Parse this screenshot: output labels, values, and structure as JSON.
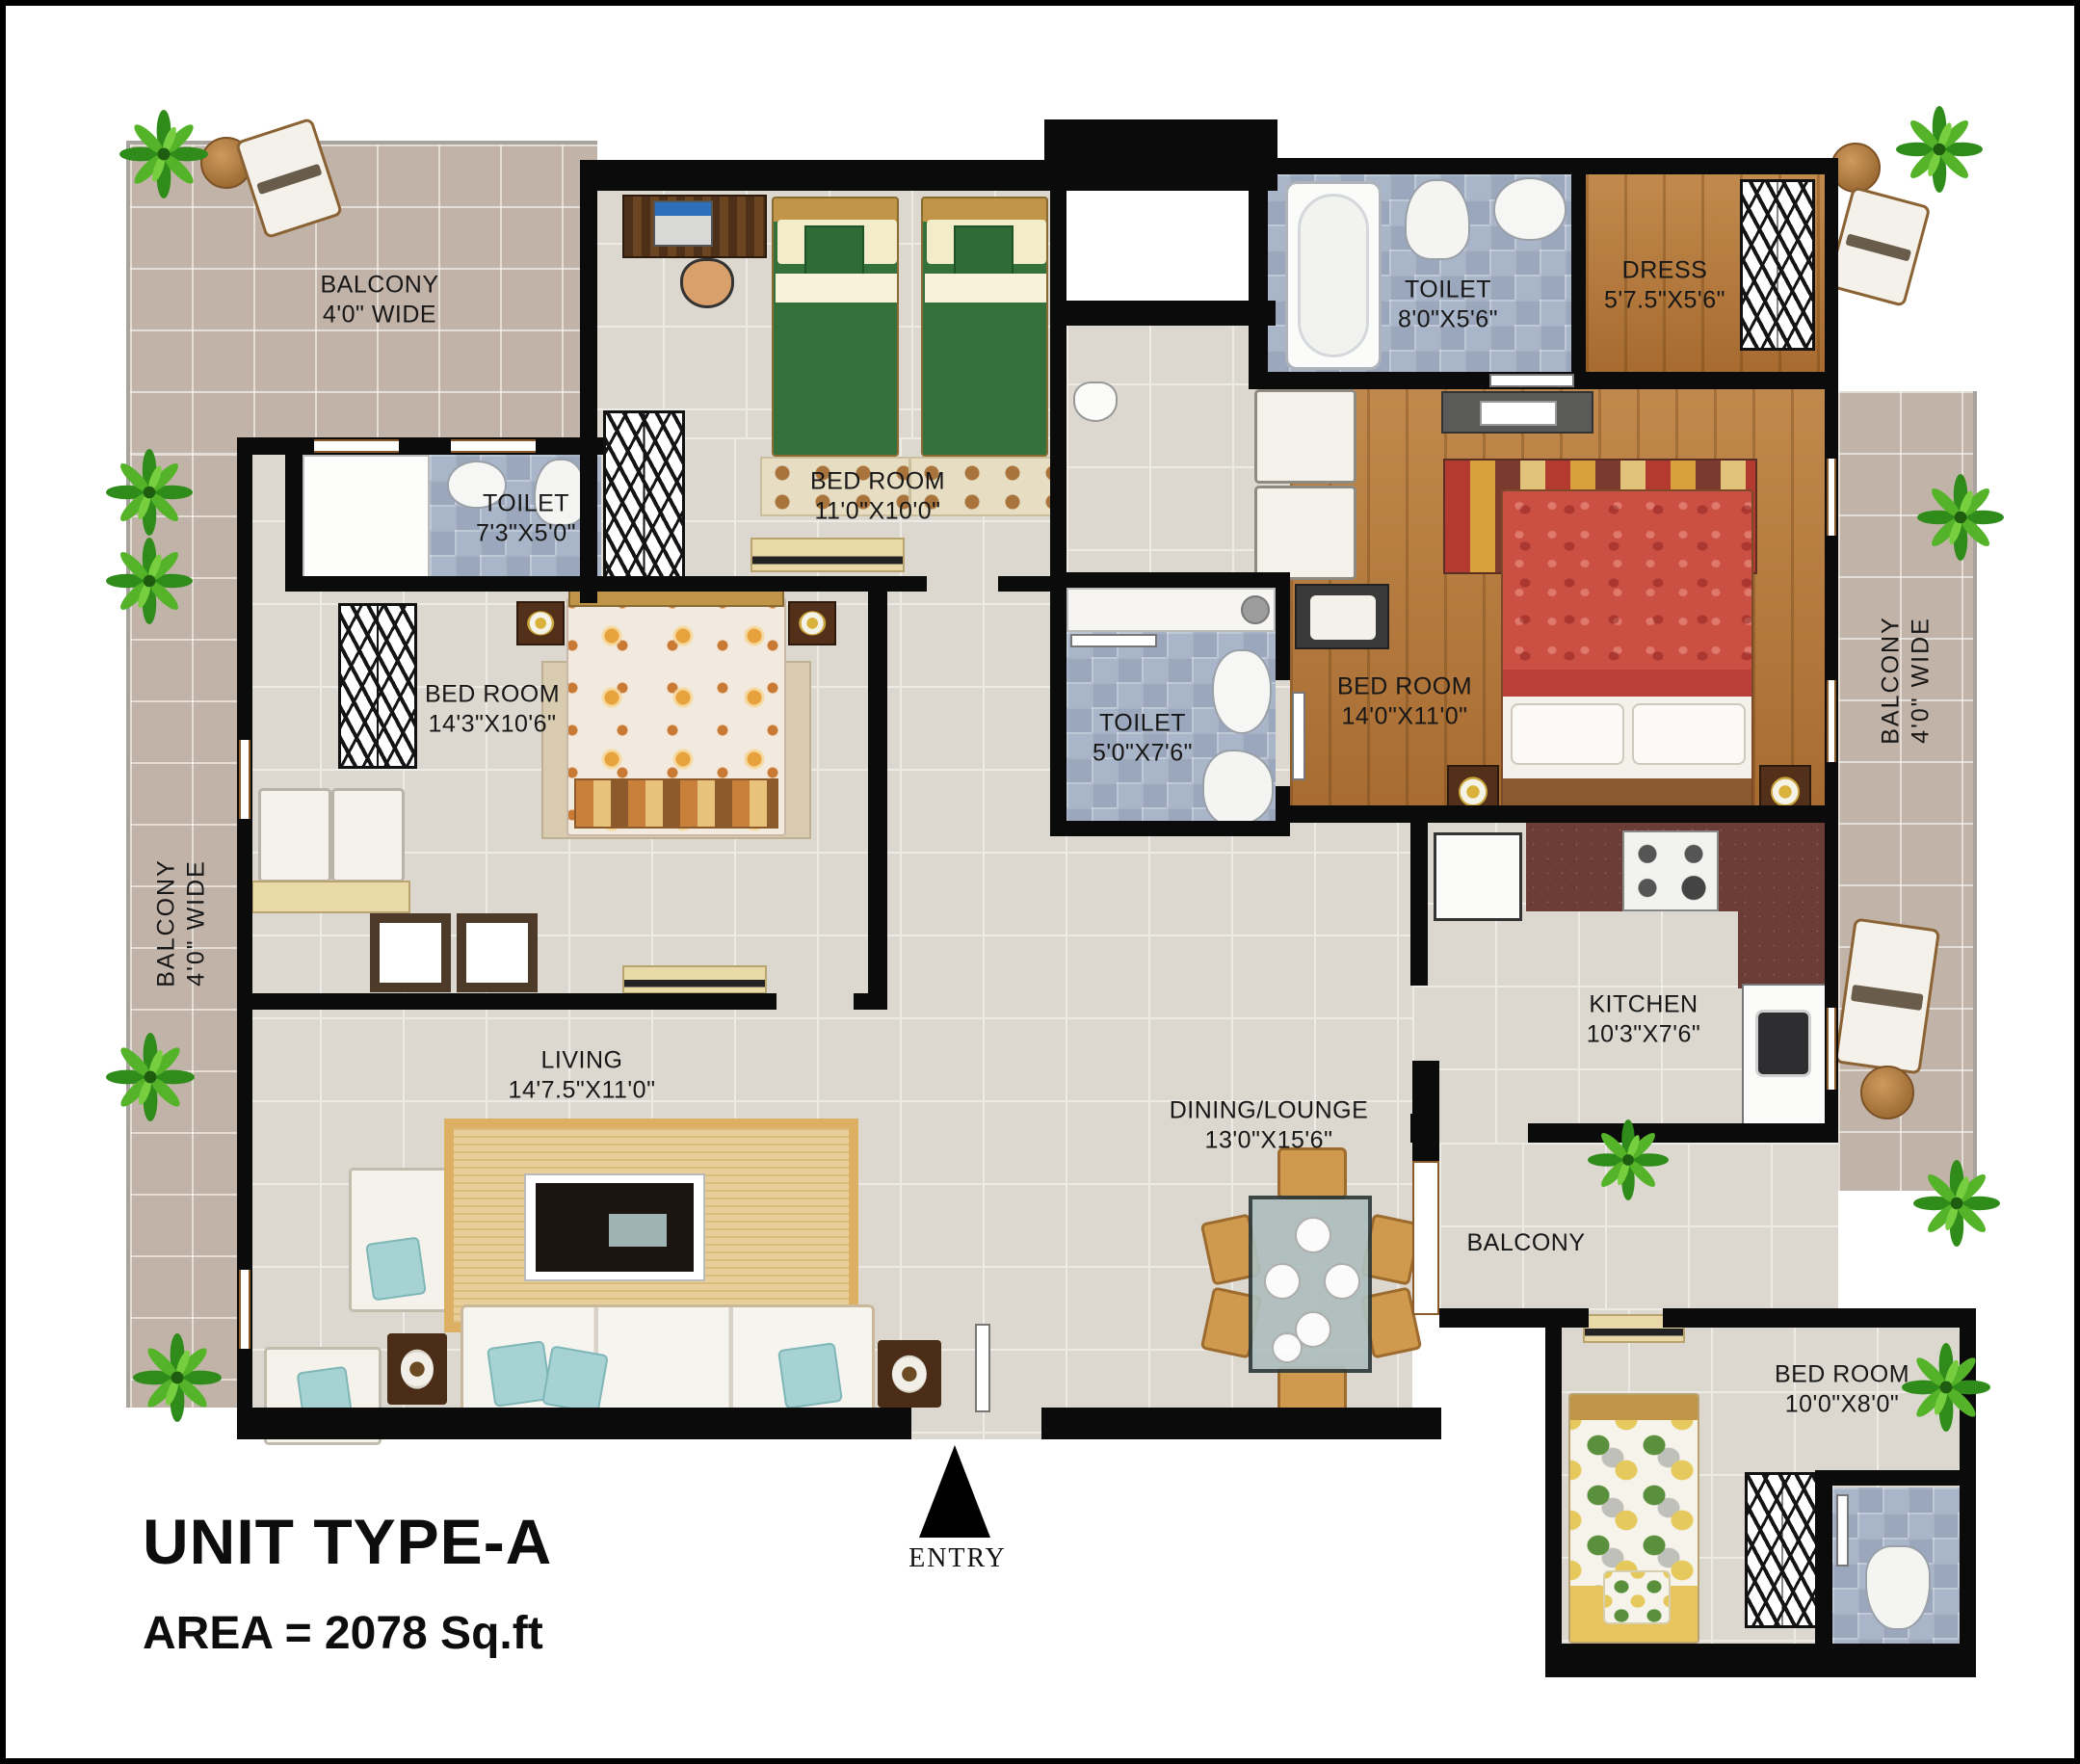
{
  "plan": {
    "unit_title": "UNIT TYPE-A",
    "area_line": "AREA = 2078 Sq.ft",
    "entry_label": "ENTRY"
  },
  "rooms": {
    "balcony_tl": {
      "name": "BALCONY",
      "size": "4'0\" WIDE"
    },
    "balcony_left": {
      "name": "BALCONY",
      "size": "4'0\" WIDE"
    },
    "balcony_right": {
      "name": "BALCONY",
      "size": "4'0\" WIDE"
    },
    "balcony_bottom": {
      "name": "BALCONY"
    },
    "toilet_tl": {
      "name": "TOILET",
      "size": "7'3\"X5'0\""
    },
    "bedroom_top": {
      "name": "BED ROOM",
      "size": "11'0\"X10'0\""
    },
    "bedroom_left": {
      "name": "BED ROOM",
      "size": "14'3\"X10'6\""
    },
    "toilet_mid": {
      "name": "TOILET",
      "size": "5'0\"X7'6\""
    },
    "toilet_tr": {
      "name": "TOILET",
      "size": "8'0\"X5'6\""
    },
    "dress": {
      "name": "DRESS",
      "size": "5'7.5\"X5'6\""
    },
    "bedroom_master": {
      "name": "BED ROOM",
      "size": "14'0\"X11'0\""
    },
    "kitchen": {
      "name": "KITCHEN",
      "size": "10'3\"X7'6\""
    },
    "living": {
      "name": "LIVING",
      "size": "14'7.5\"X11'0\""
    },
    "dining": {
      "name": "DINING/LOUNGE",
      "size": "13'0\"X15'6\""
    },
    "bedroom_small": {
      "name": "BED ROOM",
      "size": "10'0\"X8'0\""
    }
  },
  "colors": {
    "wall": "#0b0b0b",
    "floor": "#dcd8d0",
    "balcony_tile": "#c2b3a9",
    "toilet_tile": "#a9b5c8",
    "wood_floor": "#b4783b",
    "kitchen_granite": "#6b3d36",
    "plant_green": "#3f9a1f"
  }
}
